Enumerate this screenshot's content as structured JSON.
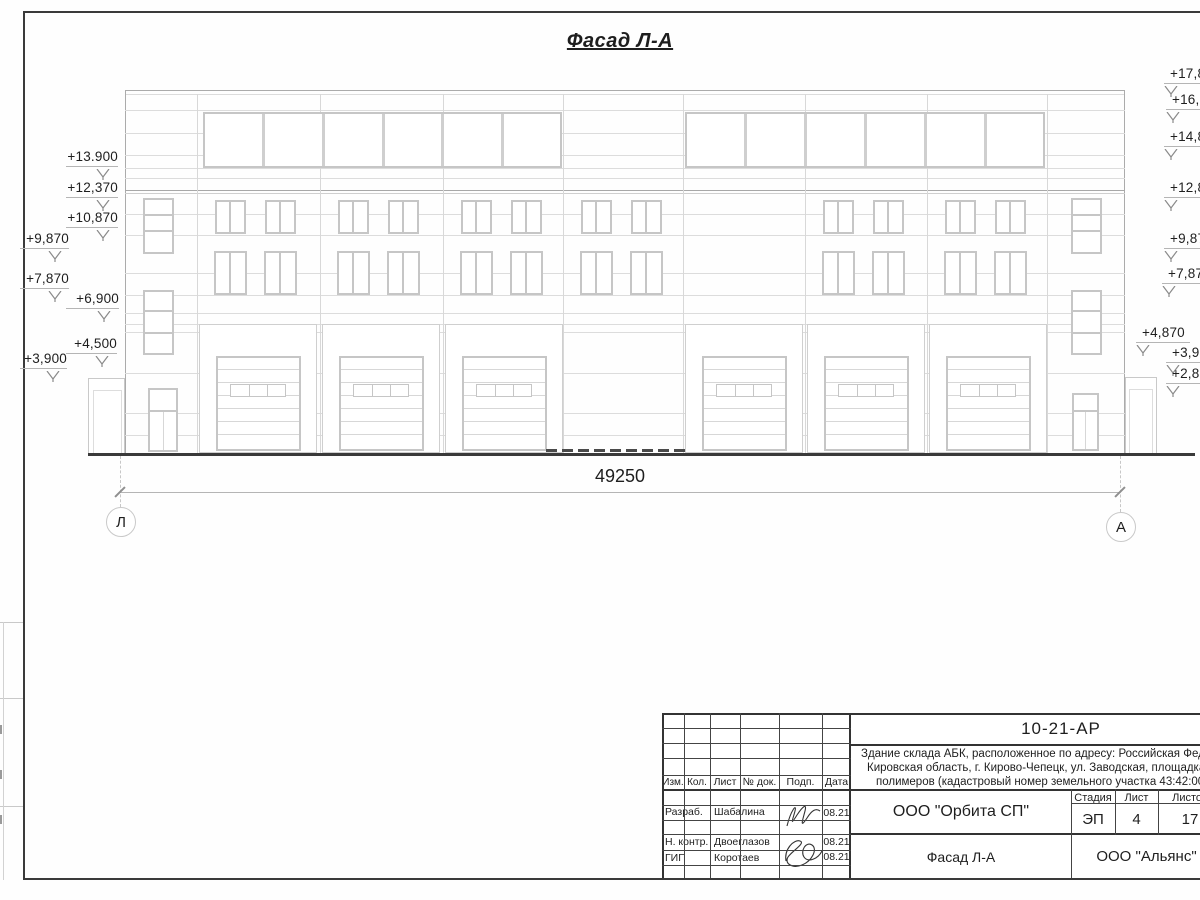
{
  "title": "Фасад Л-А",
  "dimension": {
    "value": "49250"
  },
  "axes": [
    {
      "label": "Л"
    },
    {
      "label": "А"
    }
  ],
  "elevation": {
    "left": [
      {
        "text": "+13.900",
        "ty": 149,
        "sy": 166,
        "x1": 66,
        "x2": 118,
        "ax": 103
      },
      {
        "text": "+12,370",
        "ty": 180,
        "sy": 197,
        "x1": 66,
        "x2": 118,
        "ax": 103
      },
      {
        "text": "+10,870",
        "ty": 210,
        "sy": 227,
        "x1": 66,
        "x2": 118,
        "ax": 103
      },
      {
        "text": "+9,870",
        "ty": 231,
        "sy": 248,
        "x1": 20,
        "x2": 69,
        "ax": 55
      },
      {
        "text": "+7,870",
        "ty": 271,
        "sy": 288,
        "x1": 20,
        "x2": 69,
        "ax": 55
      },
      {
        "text": "+6,900",
        "ty": 291,
        "sy": 308,
        "x1": 66,
        "x2": 119,
        "ax": 104
      },
      {
        "text": "+4,500",
        "ty": 336,
        "sy": 353,
        "x1": 66,
        "x2": 117,
        "ax": 102
      },
      {
        "text": "+3,900",
        "ty": 351,
        "sy": 368,
        "x1": 20,
        "x2": 67,
        "ax": 53
      }
    ],
    "right": [
      {
        "text": "+17,870",
        "lx": 1170,
        "ty": 66,
        "sy": 83
      },
      {
        "text": "+16,870",
        "lx": 1172,
        "ty": 92,
        "sy": 109
      },
      {
        "text": "+14,870",
        "lx": 1170,
        "ty": 129,
        "sy": 146
      },
      {
        "text": "+12,870",
        "lx": 1170,
        "ty": 180,
        "sy": 197
      },
      {
        "text": "+9,870",
        "lx": 1170,
        "ty": 231,
        "sy": 248
      },
      {
        "text": "+7,870",
        "lx": 1168,
        "ty": 266,
        "sy": 283
      },
      {
        "text": "+4,870",
        "lx": 1142,
        "ty": 325,
        "sy": 342,
        "x2": 1190
      },
      {
        "text": "+3,900",
        "lx": 1172,
        "ty": 345,
        "sy": 362
      },
      {
        "text": "+2,870",
        "lx": 1172,
        "ty": 366,
        "sy": 383
      }
    ]
  },
  "stamp": {
    "doc_number": "10-21-АР",
    "description_lines": [
      "Здание склада АБК, расположенное по адресу: Российская Федерация,",
      "Кировская область, г. Кирово-Чепецк, ул. Заводская, площадка завода",
      "полимеров (кадастровый номер земельного участка 43:42:000022:"
    ],
    "columns": [
      "Изм.",
      "Кол.",
      "Лист",
      "№ док.",
      "Подп.",
      "Дата"
    ],
    "rows": [
      {
        "role": "Разраб.",
        "name": "Шабалина",
        "date": "08.21"
      },
      {
        "role": "Н. контр.",
        "name": "Двоеглазов",
        "date": "08.21"
      },
      {
        "role": "ГИП",
        "name": "Коротаев",
        "date": "08.21"
      }
    ],
    "stage_header": "Стадия",
    "sheet_header": "Лист",
    "sheets_header": "Листов",
    "stage": "ЭП",
    "sheet": "4",
    "sheets": "17",
    "org": "ООО \"Орбита СП\"",
    "sheet_title": "Фасад Л-А",
    "contractor": "ООО \"Альянс\""
  },
  "colors": {
    "joint": "#dcdcdc",
    "frame": "#c6c6c6",
    "outline": "#ababab",
    "level": "#a8a8a8",
    "dark": "#3a3a3a",
    "dim": "#b5b5b5",
    "text": "#1e1e1e"
  }
}
